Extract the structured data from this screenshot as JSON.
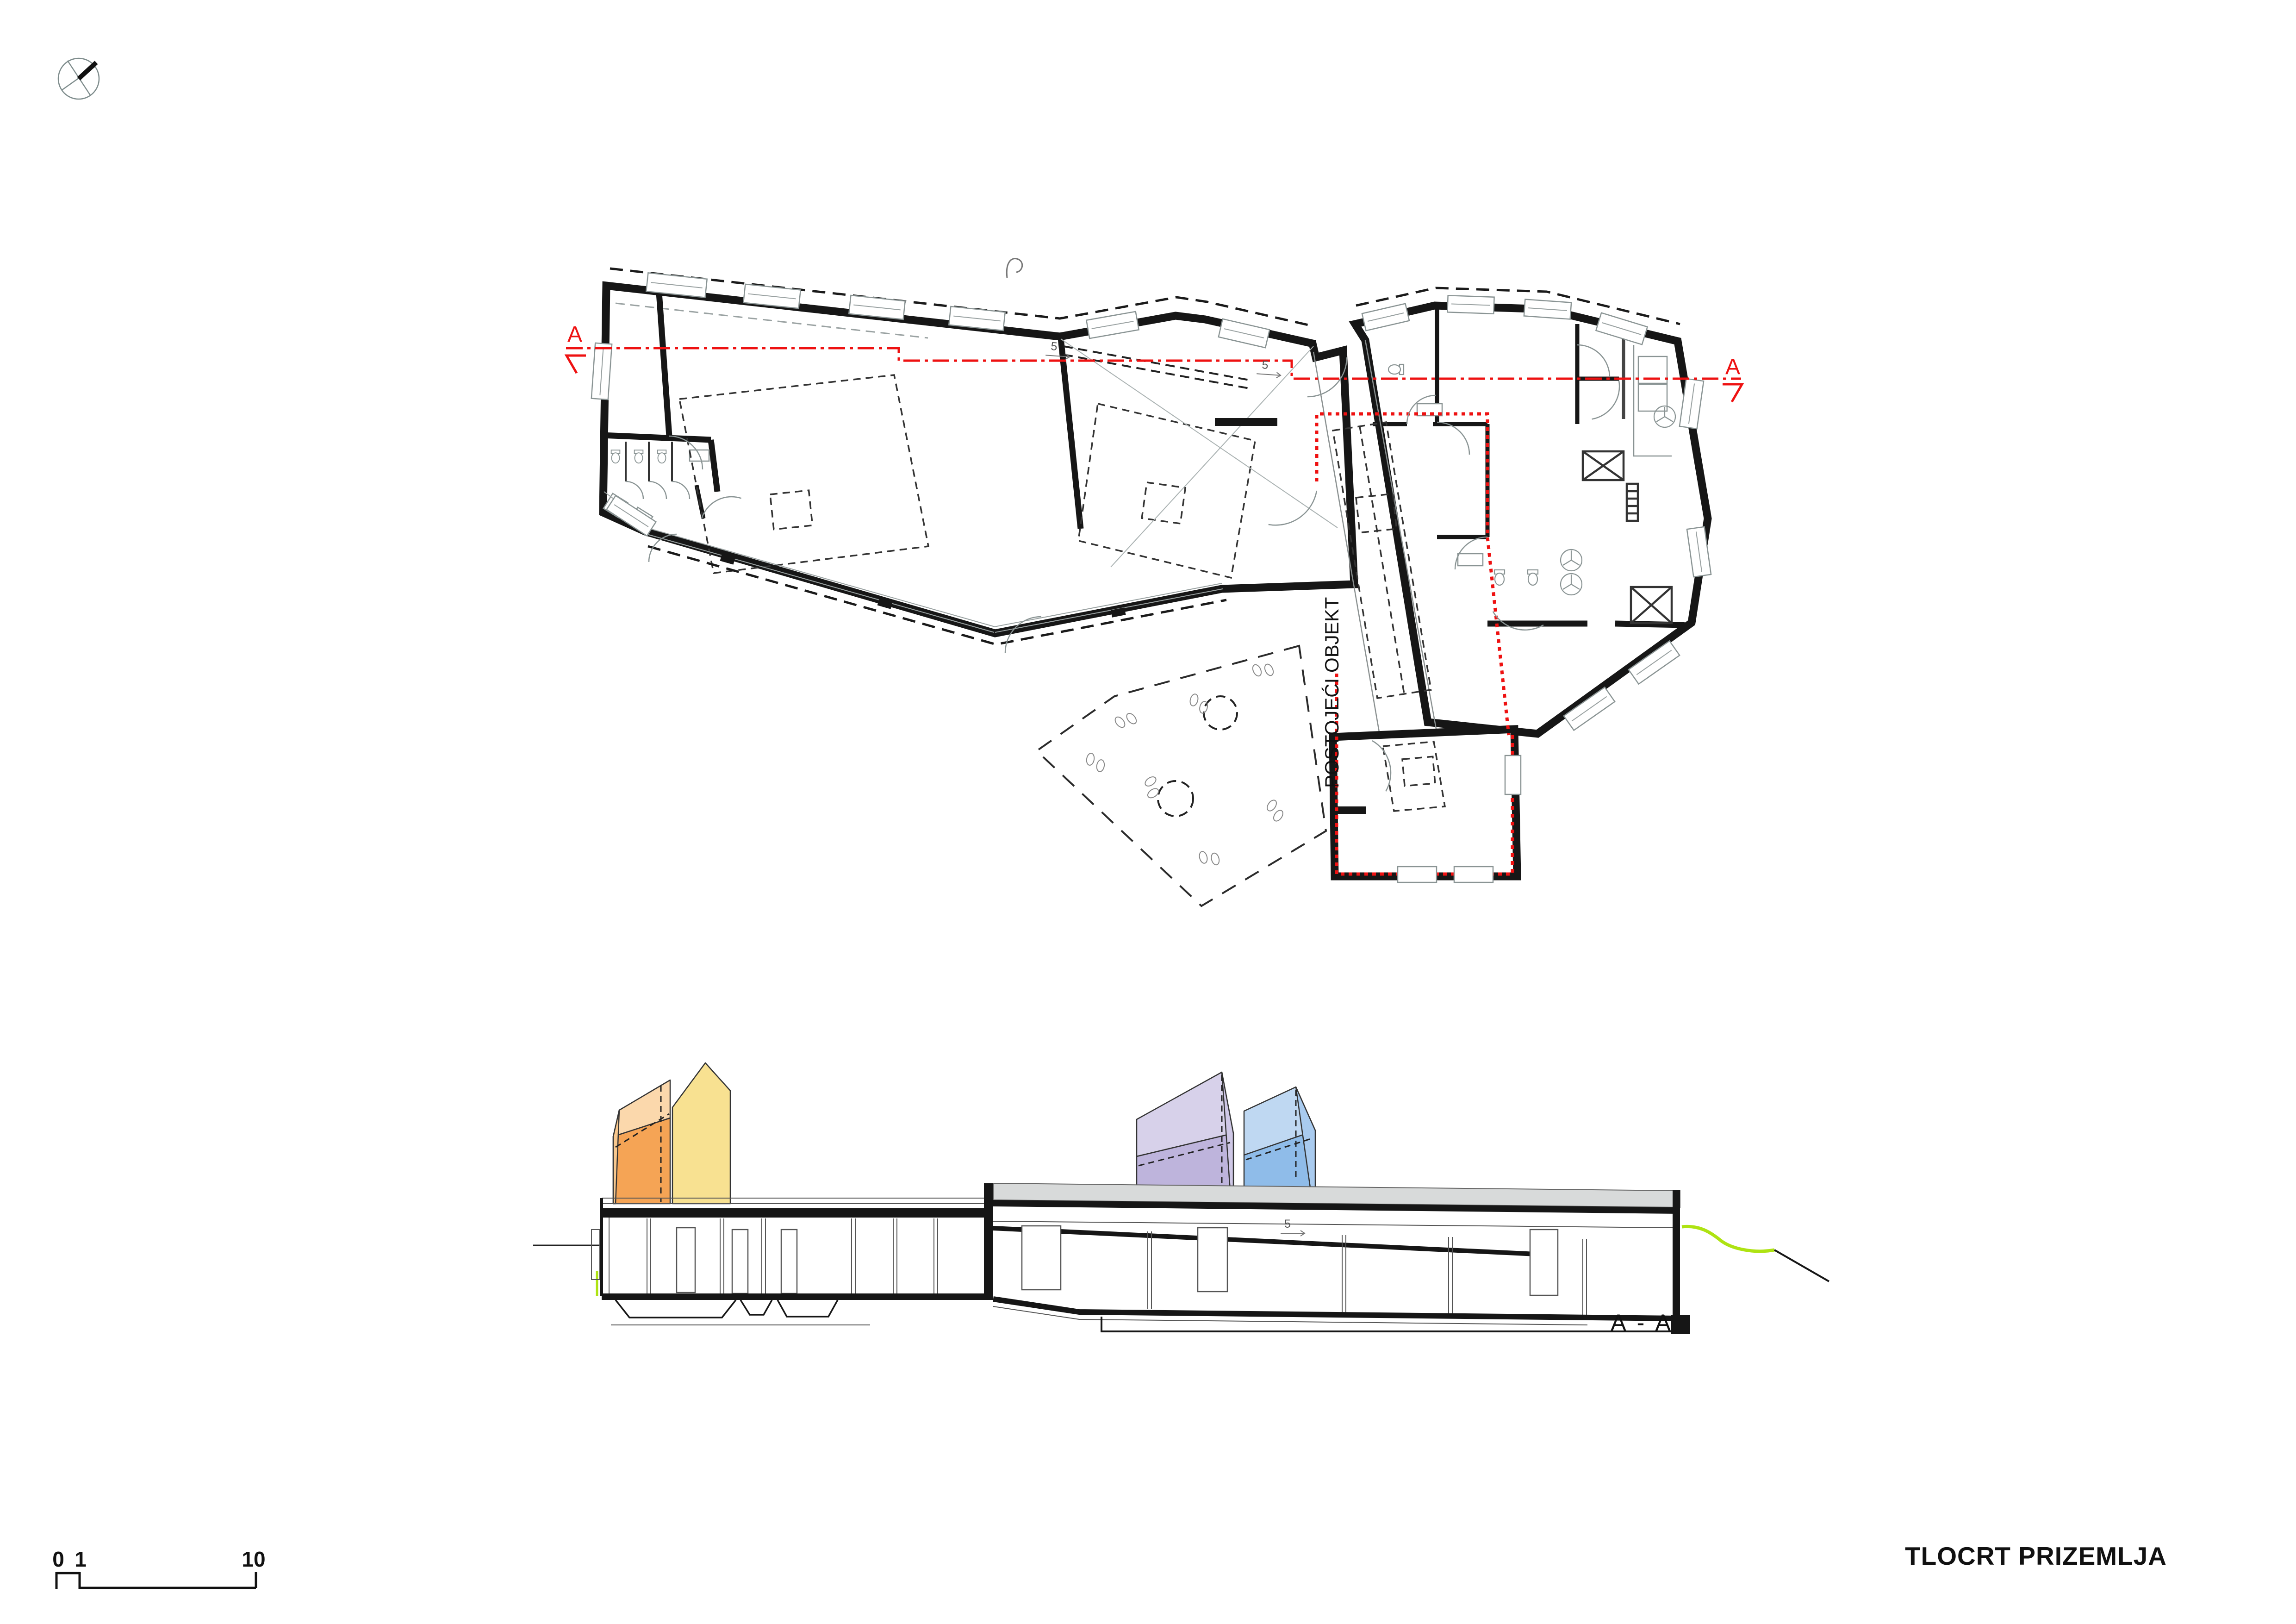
{
  "title": {
    "text": "TLOCRT PRIZEMLJA"
  },
  "icons": {
    "north_arrow": "north-arrow-compass-icon"
  },
  "plan": {
    "existing_object_label": "POSTOJEĆI OBJEKT",
    "section_line": {
      "start_label": "A",
      "end_label": "A"
    },
    "slope_annotations": [
      {
        "label": "5"
      },
      {
        "label": "5"
      }
    ]
  },
  "section": {
    "label": "A - A",
    "slope_annotation": {
      "label": "5"
    },
    "houses": [
      {
        "name": "orange-house",
        "roof_color": "#FBD8AC",
        "wall_color": "#F5A455",
        "gable_color": "#F8C88E"
      },
      {
        "name": "yellow-house",
        "roof_color": "#F8E191",
        "wall_color": "#F8E191",
        "gable_color": "#F8E191"
      },
      {
        "name": "purple-house",
        "roof_color": "#D7D1EA",
        "wall_color": "#BEB4DC",
        "gable_color": "#CFC8E6"
      },
      {
        "name": "blue-house",
        "roof_color": "#BFD8F2",
        "wall_color": "#8FBCE9",
        "gable_color": "#A9CBEF"
      }
    ]
  },
  "scale_bar": {
    "labels": [
      "0",
      "1",
      "10"
    ]
  },
  "colors": {
    "accent_red": "#EE1111",
    "terrain_green": "#AEE312",
    "parapet_gray": "#D8DADA",
    "drawing_black": "#161616",
    "drawing_gray": "#8A9494"
  }
}
